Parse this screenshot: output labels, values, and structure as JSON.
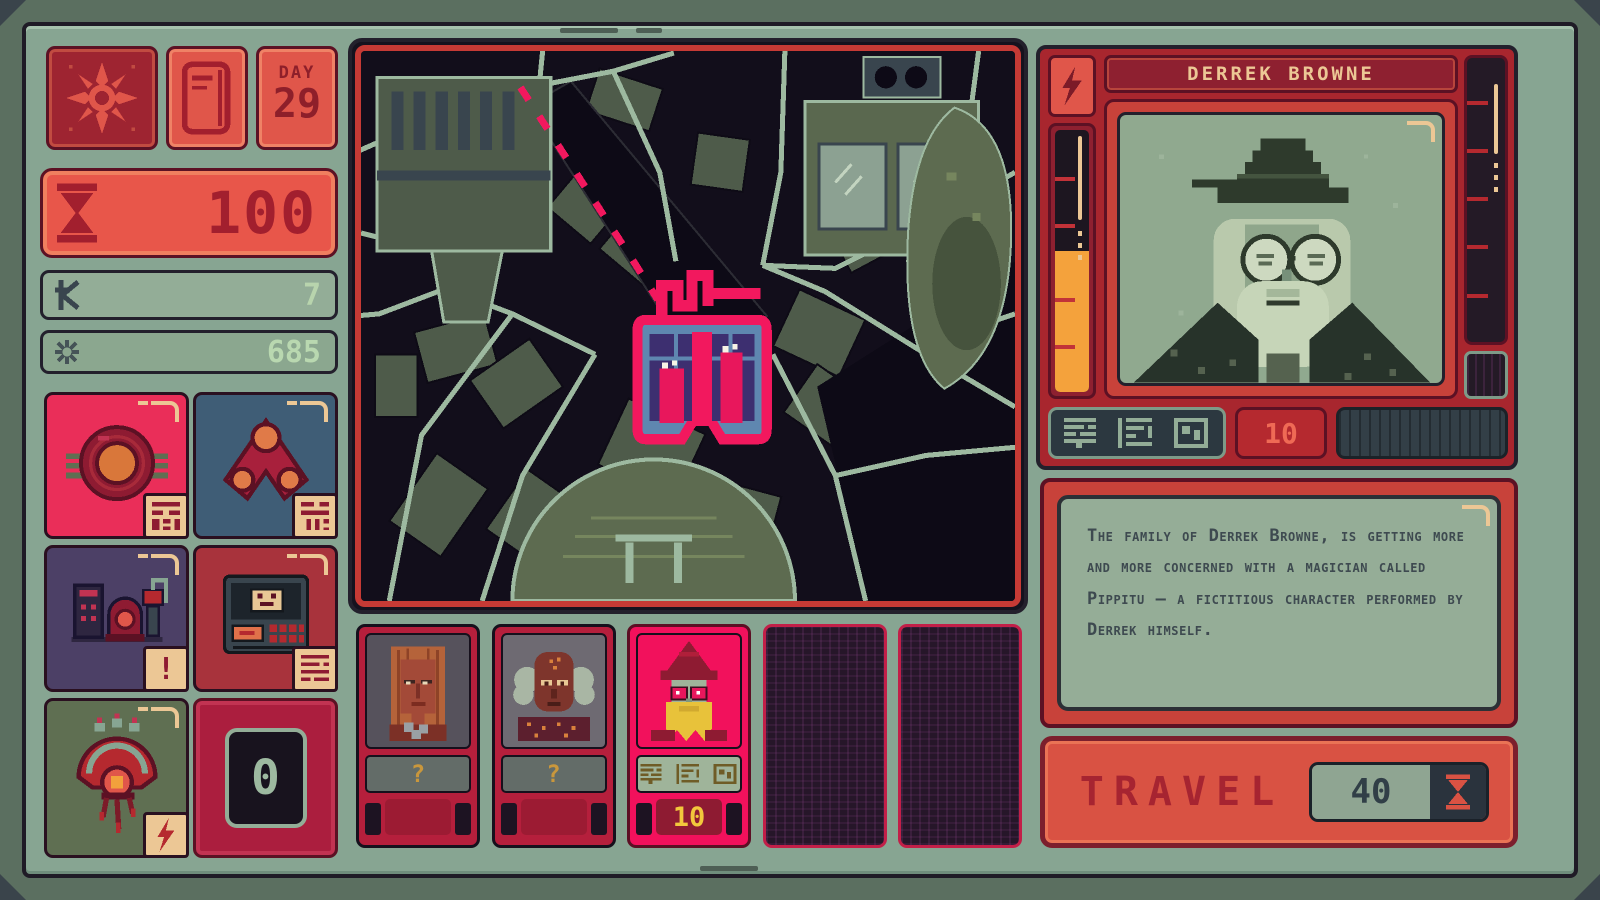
{
  "hud": {
    "day_label": "DAY",
    "day_value": "29",
    "time_points": "100",
    "credits": "7",
    "lumens": "685",
    "counter": "0",
    "alert_badge": "!"
  },
  "map": {
    "destination_selected": true,
    "route_style": "dashed-pink"
  },
  "party": {
    "slots": [
      {
        "type": "recruit",
        "label": "?"
      },
      {
        "type": "recruit",
        "label": "?"
      },
      {
        "type": "selected",
        "fee": "10"
      },
      {
        "type": "empty"
      },
      {
        "type": "empty"
      }
    ]
  },
  "profile": {
    "name": "DERREK BROWNE",
    "fee": "10",
    "description": "The family of Derrek Browne, is getting more and more concerned with a magician called Pippitu – a fictitious character performed by Derrek himself.",
    "energy_gauge_pct": 54,
    "aux_gauge_pct": 0
  },
  "travel": {
    "label": "TRAVEL",
    "cost": "40"
  },
  "icons": {
    "compass": "compass-rose",
    "journal": "journal-door",
    "hourglass": "hourglass",
    "credits": "kredit-sign",
    "lumens": "sun-asterisk",
    "lightning": "bolt",
    "unknown": "?"
  },
  "colors": {
    "accent_pink": "#f2115c",
    "panel_red": "#a8262e",
    "bezel_sage": "#87a592",
    "gauge_orange": "#f4a23c",
    "tan": "#ecc795",
    "map_road": "#9db9a0"
  }
}
